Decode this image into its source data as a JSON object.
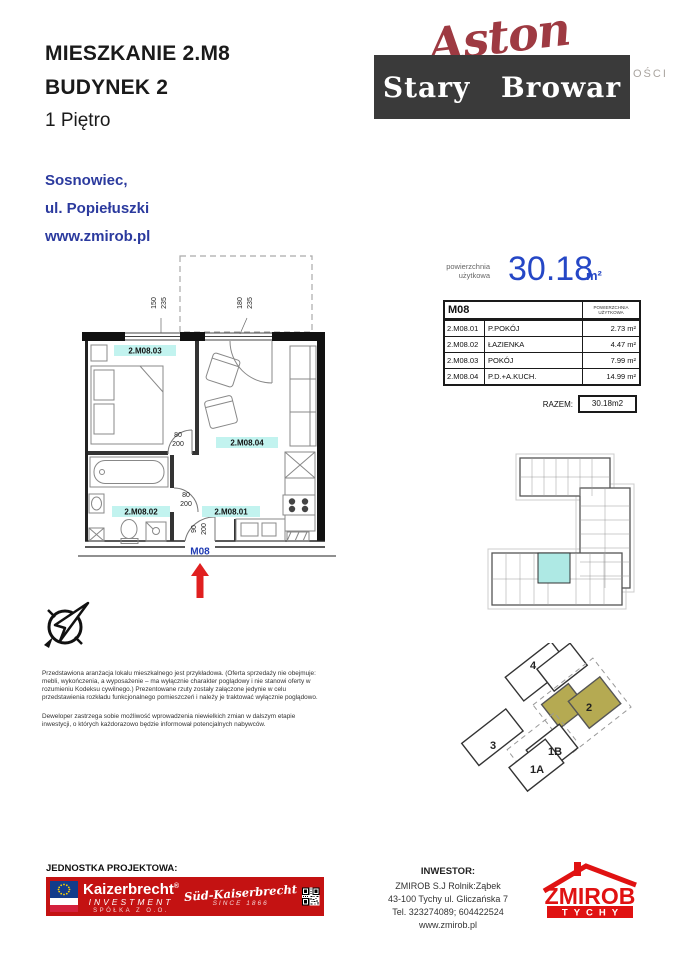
{
  "header": {
    "title_line1": "MIESZKANIE 2.M8",
    "title_line2": "BUDYNEK 2",
    "floor": "1 Piętro",
    "city": "Sosnowiec,",
    "street": "ul. Popiełuszki",
    "website": "www.zmirob.pl"
  },
  "brand": {
    "aston": "Aston",
    "aston_suffix": "OŚCI",
    "estate": "Stary Browar"
  },
  "area_summary": {
    "label_line1": "powierzchnia",
    "label_line2": "użytkowa",
    "value": "30.18",
    "unit": "m²"
  },
  "area_table": {
    "unit_code": "M08",
    "col_header_line1": "POWIERZCHNIA",
    "col_header_line2": "UŻYTKOWA",
    "rows": [
      {
        "code": "2.M08.01",
        "name": "P.POKÓJ",
        "area": "2.73 m²"
      },
      {
        "code": "2.M08.02",
        "name": "ŁAZIENKA",
        "area": "4.47 m²"
      },
      {
        "code": "2.M08.03",
        "name": "POKÓJ",
        "area": "7.99 m²"
      },
      {
        "code": "2.M08.04",
        "name": "P.D.+A.KUCH.",
        "area": "14.99 m²"
      }
    ],
    "total_label": "RAZEM:",
    "total_value": "30.18m2"
  },
  "floor_plan": {
    "unit_label": "M08",
    "rooms": {
      "r01": "2.M08.01",
      "r02": "2.M08.02",
      "r03": "2.M08.03",
      "r04": "2.M08.04"
    },
    "dims": {
      "window1_w": "150",
      "window1_h": "235",
      "window2_w": "180",
      "window2_h": "235",
      "door1_w": "80",
      "door1_h": "200",
      "door2_w": "80",
      "door2_h": "200",
      "entrance_w": "90",
      "entrance_h": "200"
    }
  },
  "site_plan": {
    "building4": "4",
    "building2": "2",
    "building3": "3",
    "building1b": "1B",
    "building1a": "1A"
  },
  "legal": {
    "para1": "Przedstawiona aranżacja lokalu mieszkalnego jest przykładowa. (Oferta sprzedaży nie obejmuje: mebli, wykończenia, a wyposażenie – ma wyłącznie charakter poglądowy i nie stanowi oferty w rozumieniu Kodeksu cywilnego.) Prezentowane rzuty zostały załączone jedynie w celu przedstawienia rozkładu funkcjonalnego pomieszczeń i należy je traktować wyłącznie poglądowo.",
    "para2": "Deweloper zastrzega sobie możliwość wprowadzenia niewielkich zmian w dalszym etapie inwestycji, o których każdorazowo będzie informował potencjalnych nabywców."
  },
  "footer": {
    "design_unit_label": "JEDNOSTKA PROJEKTOWA:",
    "kaizerbrecht": {
      "name": "Kaizerbrecht",
      "reg": "®",
      "investment": "INVESTMENT",
      "company": "SPÓŁKA Z O.O.",
      "script": "Süd-Kaiserbrecht",
      "since": "SINCE 1866"
    },
    "investor": {
      "label": "INWESTOR:",
      "line1": "ZMIROB S.J Rolnik:Ząbek",
      "line2": "43-100 Tychy ul. Gliczańska 7",
      "line3": "Tel. 323274089; 604422524",
      "line4": "www.zmirob.pl"
    },
    "zmirob": {
      "name": "ZMIROB",
      "city": "TYCHY"
    }
  },
  "colors": {
    "accent_blue": "#2b3a9e",
    "area_blue": "#2547c6",
    "highlight_cyan": "#c2f3ef",
    "brand_red": "#9e3a42",
    "banner_red": "#c41212",
    "zmirob_red": "#e01212",
    "site_highlight_khaki": "#b5aa52",
    "arrow_red": "#e02020"
  }
}
